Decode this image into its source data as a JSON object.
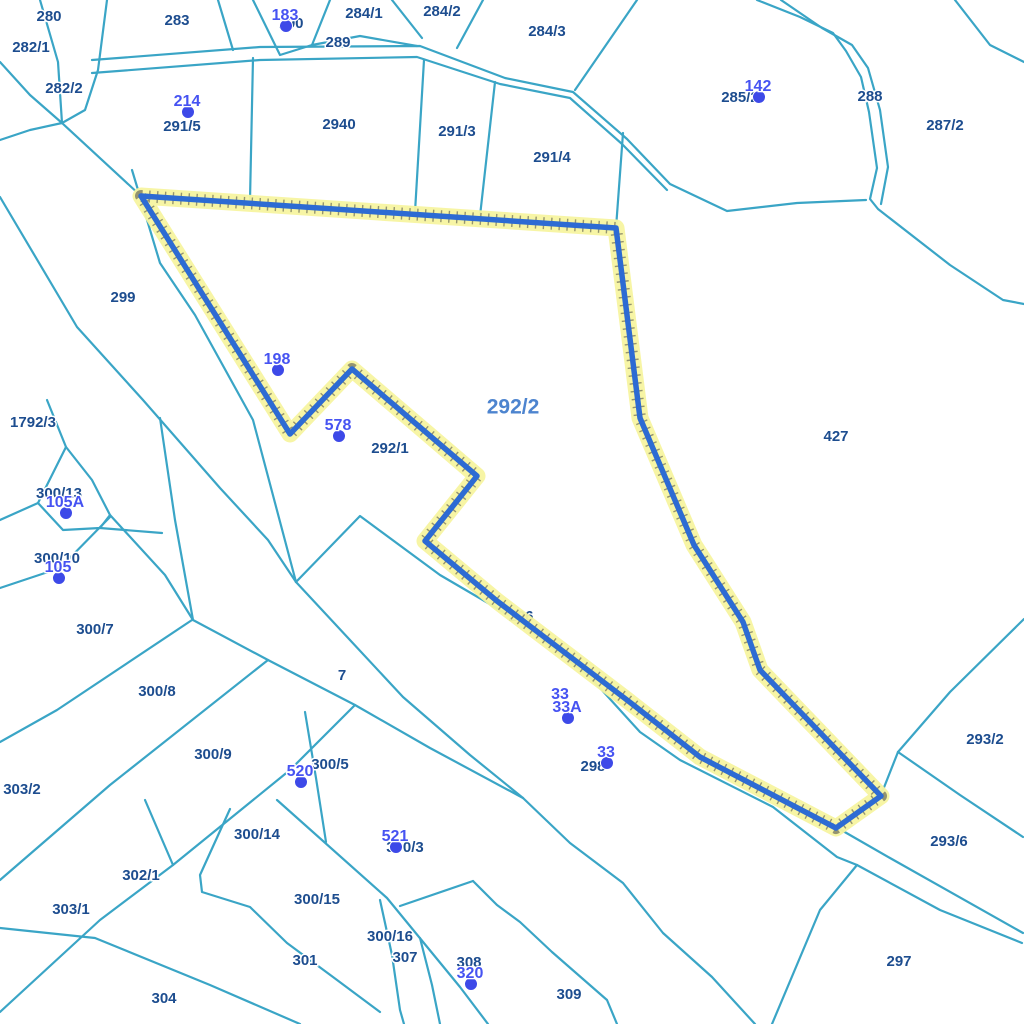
{
  "map": {
    "title": "cadastral-parcel-map",
    "background": "#ffffff",
    "colors": {
      "boundary_line": "#3aa5c6",
      "parcel_label": "#1d4d8f",
      "label_halo": "#ffffff",
      "pin_text": "#4653f2",
      "pin_dot": "#3d49e8",
      "highlight_stroke": "#2d6bd3",
      "highlight_glow": "#f7f4a0",
      "highlight_ticks": "#444444",
      "highlight_label_color": "#4d84cf"
    },
    "highlight": {
      "parcel_label": "292/2",
      "label_x": 513,
      "label_y": 408,
      "points": "141,196 616,228 640,418 694,545 743,622 760,670 881,796 836,828 700,757 627,700 497,601 425,541 477,476 352,369 290,434"
    },
    "labels_under": [
      {
        "text": "296",
        "x": 521,
        "y": 621
      }
    ],
    "parcel_labels": [
      {
        "text": "280",
        "x": 49,
        "y": 17
      },
      {
        "text": "282/1",
        "x": 31,
        "y": 48
      },
      {
        "text": "283",
        "x": 177,
        "y": 21
      },
      {
        "text": "290",
        "x": 291,
        "y": 24
      },
      {
        "text": "284/1",
        "x": 364,
        "y": 14
      },
      {
        "text": "284/2",
        "x": 442,
        "y": 12
      },
      {
        "text": "289",
        "x": 338,
        "y": 43
      },
      {
        "text": "284/3",
        "x": 547,
        "y": 32
      },
      {
        "text": "285/2",
        "x": 740,
        "y": 98
      },
      {
        "text": "288",
        "x": 870,
        "y": 97
      },
      {
        "text": "287/2",
        "x": 945,
        "y": 126
      },
      {
        "text": "282/2",
        "x": 64,
        "y": 89
      },
      {
        "text": "291/5",
        "x": 182,
        "y": 127
      },
      {
        "text": "2940",
        "x": 339,
        "y": 125
      },
      {
        "text": "291/3",
        "x": 457,
        "y": 132
      },
      {
        "text": "291/4",
        "x": 552,
        "y": 158
      },
      {
        "text": "299",
        "x": 123,
        "y": 298
      },
      {
        "text": "1792/3",
        "x": 33,
        "y": 423
      },
      {
        "text": "292/1",
        "x": 390,
        "y": 449
      },
      {
        "text": "427",
        "x": 836,
        "y": 437
      },
      {
        "text": "300/13",
        "x": 59,
        "y": 494
      },
      {
        "text": "300/10",
        "x": 57,
        "y": 559
      },
      {
        "text": "300/7",
        "x": 95,
        "y": 630
      },
      {
        "text": "300/8",
        "x": 157,
        "y": 692
      },
      {
        "text": "300/9",
        "x": 213,
        "y": 755
      },
      {
        "text": "303/2",
        "x": 22,
        "y": 790
      },
      {
        "text": "7",
        "x": 342,
        "y": 676
      },
      {
        "text": "300/5",
        "x": 330,
        "y": 765
      },
      {
        "text": "298",
        "x": 593,
        "y": 767
      },
      {
        "text": "293/2",
        "x": 985,
        "y": 740
      },
      {
        "text": "293/6",
        "x": 949,
        "y": 842
      },
      {
        "text": "300/14",
        "x": 257,
        "y": 835
      },
      {
        "text": "302/1",
        "x": 141,
        "y": 876
      },
      {
        "text": "300/3",
        "x": 405,
        "y": 848
      },
      {
        "text": "300/15",
        "x": 317,
        "y": 900
      },
      {
        "text": "300/16",
        "x": 390,
        "y": 937
      },
      {
        "text": "307",
        "x": 405,
        "y": 958
      },
      {
        "text": "301",
        "x": 305,
        "y": 961
      },
      {
        "text": "303/1",
        "x": 71,
        "y": 910
      },
      {
        "text": "304",
        "x": 164,
        "y": 999
      },
      {
        "text": "308",
        "x": 469,
        "y": 963
      },
      {
        "text": "309",
        "x": 569,
        "y": 995
      },
      {
        "text": "297",
        "x": 899,
        "y": 962
      }
    ],
    "pin_labels": [
      {
        "text": "183",
        "x": 285,
        "y": 16,
        "dot": true
      },
      {
        "text": "214",
        "x": 187,
        "y": 102,
        "dot": true
      },
      {
        "text": "142",
        "x": 758,
        "y": 87,
        "dot": true
      },
      {
        "text": "198",
        "x": 277,
        "y": 360,
        "dot": true
      },
      {
        "text": "578",
        "x": 338,
        "y": 426,
        "dot": true
      },
      {
        "text": "105A",
        "x": 65,
        "y": 503,
        "dot": true
      },
      {
        "text": "105",
        "x": 58,
        "y": 568,
        "dot": true
      },
      {
        "text": "520",
        "x": 300,
        "y": 772,
        "dot": true
      },
      {
        "text": "521",
        "x": 395,
        "y": 837,
        "dot": true
      },
      {
        "text": "33",
        "x": 560,
        "y": 695,
        "dot": false
      },
      {
        "text": "33A",
        "x": 567,
        "y": 708,
        "dot": true
      },
      {
        "text": "33",
        "x": 606,
        "y": 753,
        "dot": true
      },
      {
        "text": "320",
        "x": 470,
        "y": 974,
        "dot": true
      }
    ],
    "boundary_lines": [
      {
        "points": "92,60 260,47 420,46 505,78 573,92 627,139 670,184 727,211 797,203 866,200"
      },
      {
        "points": "92,73 260,60 417,57 500,84 570,98 622,144 667,190"
      },
      {
        "points": "757,0 800,17 833,33 846,51 861,77 869,112 877,168 870,199 878,209 950,265 1003,300 1024,304"
      },
      {
        "points": "781,0 822,28 852,45 868,68 880,110 888,167 881,204"
      },
      {
        "points": "955,0 990,45 1024,62"
      },
      {
        "points": "40,0 58,62 62,123"
      },
      {
        "points": "107,0 98,70 85,110 62,123"
      },
      {
        "points": "0,62 30,95 62,123"
      },
      {
        "points": "0,140 30,130 62,123"
      },
      {
        "points": "62,123 141,196"
      },
      {
        "points": "218,0 233,50"
      },
      {
        "points": "253,0 280,55 312,45 330,0"
      },
      {
        "points": "312,45 360,36 417,46"
      },
      {
        "points": "253,58 250,200"
      },
      {
        "points": "424,60 415,212"
      },
      {
        "points": "495,82 480,216"
      },
      {
        "points": "623,133 616,228"
      },
      {
        "points": "457,48 483,0"
      },
      {
        "points": "392,0 422,38"
      },
      {
        "points": "637,0 575,90"
      },
      {
        "points": "132,170 160,263 195,315 253,420 296,582"
      },
      {
        "points": "0,197 77,327 143,400 220,488 268,540 296,582"
      },
      {
        "points": "160,418 175,520 193,620 268,660 355,705 430,748 523,798 570,843 623,883 663,933 712,977 755,1024"
      },
      {
        "points": "296,582 403,697 470,755 523,798"
      },
      {
        "points": "296,582 360,516 440,575 517,620 590,677 640,732 680,760 773,807 837,857 857,865"
      },
      {
        "points": "47,400 66,447 38,503"
      },
      {
        "points": "66,447 92,480 110,515 100,528 63,530 38,503"
      },
      {
        "points": "100,528 162,533"
      },
      {
        "points": "110,515 165,575 193,620"
      },
      {
        "points": "0,588 60,568 110,517"
      },
      {
        "points": "0,520 38,503"
      },
      {
        "points": "192,620 57,710 0,742"
      },
      {
        "points": "268,660 110,785 0,880"
      },
      {
        "points": "355,705 290,770 173,865 100,920 0,1012"
      },
      {
        "points": "145,800 173,865"
      },
      {
        "points": "0,928 95,938 210,985 300,1024"
      },
      {
        "points": "230,809 200,875 202,892 250,907 287,943 333,977 380,1012"
      },
      {
        "points": "277,800 387,898 460,987 488,1024"
      },
      {
        "points": "380,900 392,955 400,1010 404,1024"
      },
      {
        "points": "420,938 432,985 440,1024"
      },
      {
        "points": "400,906 473,881"
      },
      {
        "points": "473,881 497,905 520,922 552,952 607,1000 617,1024"
      },
      {
        "points": "305,712 316,778 326,842"
      },
      {
        "points": "1024,619 950,692 898,752"
      },
      {
        "points": "898,752 960,795 1023,837"
      },
      {
        "points": "898,752 883,790 836,827"
      },
      {
        "points": "836,827 890,858 1023,933"
      },
      {
        "points": "857,865 940,910 1022,943"
      },
      {
        "points": "857,865 820,910 772,1024"
      }
    ]
  }
}
